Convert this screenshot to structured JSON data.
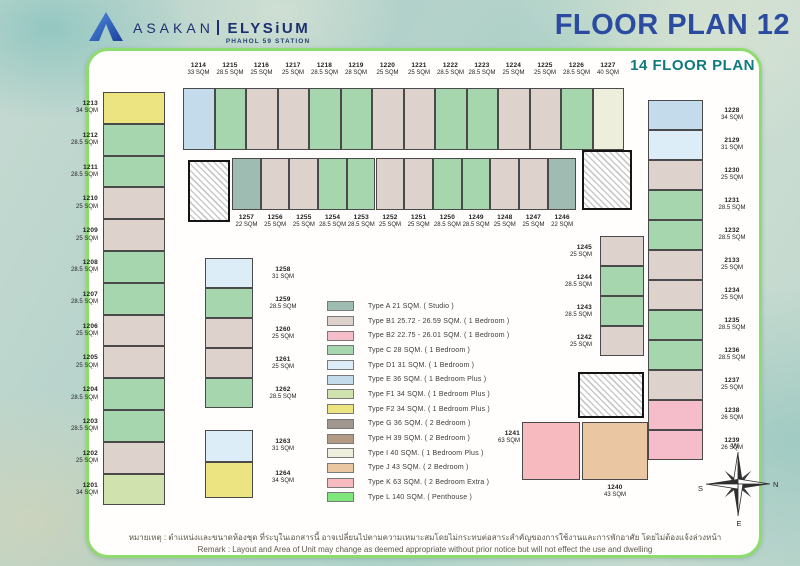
{
  "header": {
    "brand": "ASAKAN",
    "brand2": "ELYSiUM",
    "brand_sub": "PHAHOL 59 STATION",
    "title": "FLOOR PLAN 12",
    "subtitle": "14 FLOOR PLAN"
  },
  "legend": [
    {
      "code": "A",
      "name": "Type A",
      "desc": "21 SQM. ( Studio )",
      "color": "#9fbcb3"
    },
    {
      "code": "B1",
      "name": "Type B1",
      "desc": "25.72 - 26.59 SQM. ( 1 Bedroom )",
      "color": "#ded2cd"
    },
    {
      "code": "B2",
      "name": "Type B2",
      "desc": "22.75 - 26.01 SQM. ( 1 Bedroom )",
      "color": "#f4bdc9"
    },
    {
      "code": "C",
      "name": "Type C",
      "desc": "28 SQM. ( 1 Bedroom )",
      "color": "#a5d6ad"
    },
    {
      "code": "D1",
      "name": "Type D1",
      "desc": "31 SQM. ( 1 Bedroom )",
      "color": "#dcedf8"
    },
    {
      "code": "E",
      "name": "Type E",
      "desc": "36 SQM. ( 1 Bedroom Plus )",
      "color": "#c4dbec"
    },
    {
      "code": "F1",
      "name": "Type F1",
      "desc": "34 SQM. ( 1 Bedroom Plus )",
      "color": "#d0e3af"
    },
    {
      "code": "F2",
      "name": "Type F2",
      "desc": "34 SQM. ( 1 Bedroom Plus )",
      "color": "#ebe480"
    },
    {
      "code": "G",
      "name": "Type G",
      "desc": "36 SQM. ( 2 Bedroom )",
      "color": "#a29790"
    },
    {
      "code": "H",
      "name": "Type H",
      "desc": "39 SQM. ( 2 Bedroom )",
      "color": "#b29a84"
    },
    {
      "code": "I",
      "name": "Type I",
      "desc": "40 SQM. ( 1 Bedroom Plus )",
      "color": "#eeeedd"
    },
    {
      "code": "J",
      "name": "Type J",
      "desc": "43 SQM. ( 2 Bedroom )",
      "color": "#eac7a2"
    },
    {
      "code": "K",
      "name": "Type K",
      "desc": "63 SQM. ( 2 Bedroom Extra )",
      "color": "#f6babf"
    },
    {
      "code": "L",
      "name": "Type L",
      "desc": "140 SQM. ( Penthouse )",
      "color": "#7fe67b"
    }
  ],
  "units": {
    "top_row": [
      {
        "no": "1214",
        "size": "33 SQM",
        "type": "E"
      },
      {
        "no": "1215",
        "size": "28.5 SQM",
        "type": "C"
      },
      {
        "no": "1216",
        "size": "25 SQM",
        "type": "B1"
      },
      {
        "no": "1217",
        "size": "25 SQM",
        "type": "B1"
      },
      {
        "no": "1218",
        "size": "28.5 SQM",
        "type": "C"
      },
      {
        "no": "1219",
        "size": "28 SQM",
        "type": "C"
      },
      {
        "no": "1220",
        "size": "25 SQM",
        "type": "B1"
      },
      {
        "no": "1221",
        "size": "25 SQM",
        "type": "B1"
      },
      {
        "no": "1222",
        "size": "28.5 SQM",
        "type": "C"
      },
      {
        "no": "1223",
        "size": "28.5 SQM",
        "type": "C"
      },
      {
        "no": "1224",
        "size": "25 SQM",
        "type": "B1"
      },
      {
        "no": "1225",
        "size": "25 SQM",
        "type": "B1"
      },
      {
        "no": "1226",
        "size": "28.5 SQM",
        "type": "C"
      },
      {
        "no": "1227",
        "size": "40 SQM",
        "type": "I"
      }
    ],
    "inner_top_row": [
      {
        "no": "1257",
        "size": "22 SQM",
        "type": "A"
      },
      {
        "no": "1256",
        "size": "25 SQM",
        "type": "B1"
      },
      {
        "no": "1255",
        "size": "25 SQM",
        "type": "B1"
      },
      {
        "no": "1254",
        "size": "28.5 SQM",
        "type": "C"
      },
      {
        "no": "1253",
        "size": "28.5 SQM",
        "type": "C"
      },
      {
        "no": "1252",
        "size": "25 SQM",
        "type": "B1"
      },
      {
        "no": "1251",
        "size": "25 SQM",
        "type": "B1"
      },
      {
        "no": "1250",
        "size": "28.5 SQM",
        "type": "C"
      },
      {
        "no": "1249",
        "size": "28.5 SQM",
        "type": "C"
      },
      {
        "no": "1248",
        "size": "25 SQM",
        "type": "B1"
      },
      {
        "no": "1247",
        "size": "25 SQM",
        "type": "B1"
      },
      {
        "no": "1246",
        "size": "22 SQM",
        "type": "A"
      }
    ],
    "left_col": [
      {
        "no": "1213",
        "size": "34 SQM",
        "type": "F2"
      },
      {
        "no": "1212",
        "size": "28.5 SQM",
        "type": "C"
      },
      {
        "no": "1211",
        "size": "28.5 SQM",
        "type": "C"
      },
      {
        "no": "1210",
        "size": "25 SQM",
        "type": "B1"
      },
      {
        "no": "1209",
        "size": "25 SQM",
        "type": "B1"
      },
      {
        "no": "1208",
        "size": "28.5 SQM",
        "type": "C"
      },
      {
        "no": "1207",
        "size": "28.5 SQM",
        "type": "C"
      },
      {
        "no": "1206",
        "size": "25 SQM",
        "type": "B1"
      },
      {
        "no": "1205",
        "size": "25 SQM",
        "type": "B1"
      },
      {
        "no": "1204",
        "size": "28.5 SQM",
        "type": "C"
      },
      {
        "no": "1203",
        "size": "28.5 SQM",
        "type": "C"
      },
      {
        "no": "1202",
        "size": "25 SQM",
        "type": "B1"
      },
      {
        "no": "1201",
        "size": "34 SQM",
        "type": "F1"
      }
    ],
    "inner_left_col": [
      {
        "no": "1258",
        "size": "31 SQM",
        "type": "D1"
      },
      {
        "no": "1259",
        "size": "28.5 SQM",
        "type": "C"
      },
      {
        "no": "1260",
        "size": "25 SQM",
        "type": "B1"
      },
      {
        "no": "1261",
        "size": "25 SQM",
        "type": "B1"
      },
      {
        "no": "1262",
        "size": "28.5 SQM",
        "type": "C"
      },
      {
        "no": "1263",
        "size": "31 SQM",
        "type": "D1"
      },
      {
        "no": "1264",
        "size": "34 SQM",
        "type": "F2"
      }
    ],
    "right_col": [
      {
        "no": "1228",
        "size": "34 SQM",
        "type": "E"
      },
      {
        "no": "2129",
        "size": "31 SQM",
        "type": "D1"
      },
      {
        "no": "1230",
        "size": "25 SQM",
        "type": "B1"
      },
      {
        "no": "1231",
        "size": "28.5 SQM",
        "type": "C"
      },
      {
        "no": "1232",
        "size": "28.5 SQM",
        "type": "C"
      },
      {
        "no": "2133",
        "size": "25 SQM",
        "type": "B1"
      },
      {
        "no": "1234",
        "size": "25 SQM",
        "type": "B1"
      },
      {
        "no": "1235",
        "size": "28.5 SQM",
        "type": "C"
      },
      {
        "no": "1236",
        "size": "28.5 SQM",
        "type": "C"
      },
      {
        "no": "1237",
        "size": "25 SQM",
        "type": "B1"
      },
      {
        "no": "1238",
        "size": "26 SQM",
        "type": "B2"
      },
      {
        "no": "1239",
        "size": "26 SQM",
        "type": "B2"
      }
    ],
    "inner_right_col": [
      {
        "no": "1245",
        "size": "25 SQM",
        "type": "B1"
      },
      {
        "no": "1244",
        "size": "28.5 SQM",
        "type": "C"
      },
      {
        "no": "1243",
        "size": "28.5 SQM",
        "type": "C"
      },
      {
        "no": "1242",
        "size": "25 SQM",
        "type": "B1"
      }
    ],
    "bottom_units": [
      {
        "no": "1241",
        "size": "63 SQM",
        "type": "K"
      },
      {
        "no": "1240",
        "size": "43 SQM",
        "type": "J"
      }
    ]
  },
  "compass": {
    "top": "W",
    "right": "N",
    "left": "S",
    "bottom": "E"
  },
  "remark": {
    "th": "หมายเหตุ : ตำแหน่งและขนาดห้องชุด ที่ระบุในเอกสารนี้ อาจเปลี่ยนไปตามความเหมาะสมโดยไม่กระทบต่อสาระสำคัญของการใช้งานและการพักอาศัย โดยไม่ต้องแจ้งล่วงหน้า",
    "en": "Remark : Layout and Area of Unit may change as deemed appropriate without prior notice but will not effect the use and dwelling"
  }
}
